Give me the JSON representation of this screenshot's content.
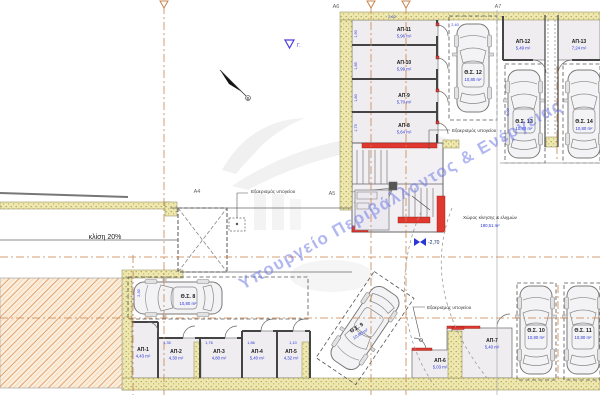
{
  "watermark": {
    "text": "Υπουργείο Περιβάλλοντος & Ενέργειας"
  },
  "grid": {
    "a4": "A4",
    "a5": "A5",
    "a6": "A6",
    "a7": "A7"
  },
  "north": {
    "label": "Β"
  },
  "levels": {
    "top_marker": "Γ.",
    "basement": "-2,70"
  },
  "annotations": {
    "ramp_slope": "κλίση 20%",
    "vent_left": "Εξαερισμός υπογείου",
    "vent_stair": "Εξαερισμός υπογείου",
    "vent_right": "Εξαερισμός υπογείου",
    "maneuver_title": "Χώρος κίνησης & ελιγμών",
    "maneuver_area": "180,51 m²"
  },
  "parking": [
    {
      "id": "Θ.Σ. 8",
      "area": "10,80 m²"
    },
    {
      "id": "Θ.Σ. 9",
      "area": "10,80 m²"
    },
    {
      "id": "Θ.Σ. 10",
      "area": "10,80 m²"
    },
    {
      "id": "Θ.Σ. 11",
      "area": "10,80 m²"
    },
    {
      "id": "Θ.Σ. 12",
      "area": "10,80 m²"
    },
    {
      "id": "Θ.Σ. 13",
      "area": "10,80 m²"
    },
    {
      "id": "Θ.Σ. 14",
      "area": "10,80 m²"
    }
  ],
  "storage": [
    {
      "id": "ΑΠ-1",
      "area": "4,43 m²"
    },
    {
      "id": "ΑΠ-2",
      "area": "4,30 m²"
    },
    {
      "id": "ΑΠ-3",
      "area": "4,80 m²"
    },
    {
      "id": "ΑΠ-4",
      "area": "5,40 m²"
    },
    {
      "id": "ΑΠ-5",
      "area": "4,32 m²"
    },
    {
      "id": "ΑΠ-6",
      "area": "5,03 m²"
    },
    {
      "id": "ΑΠ-7",
      "area": "5,40 m²"
    },
    {
      "id": "ΑΠ-8",
      "area": "5,64 m²"
    },
    {
      "id": "ΑΠ-9",
      "area": "5,70 m²"
    },
    {
      "id": "ΑΠ-10",
      "area": "5,99 m²"
    },
    {
      "id": "ΑΠ-11",
      "area": "5,96 m²"
    },
    {
      "id": "ΑΠ-12",
      "area": "5,49 m²"
    },
    {
      "id": "ΑΠ-13",
      "area": "7,24 m²"
    }
  ],
  "dims": [
    {
      "t": "1,90"
    },
    {
      "t": "1,85"
    },
    {
      "t": "1,80"
    },
    {
      "t": "1,75"
    },
    {
      "t": "2,62"
    },
    {
      "t": "2,40"
    },
    {
      "t": "5,00"
    },
    {
      "t": "2,30"
    },
    {
      "t": "1,35"
    },
    {
      "t": "1,76"
    },
    {
      "t": "1,86"
    },
    {
      "t": "1,10"
    }
  ],
  "colors": {
    "accent_red": "#e0372e",
    "dim_blue": "#2a35d8",
    "hatch_yellow": "#eee8b0",
    "earth_orange": "#e2a36e",
    "gridline_tan": "#c8824a",
    "watermark_blue": "#6470e4"
  }
}
